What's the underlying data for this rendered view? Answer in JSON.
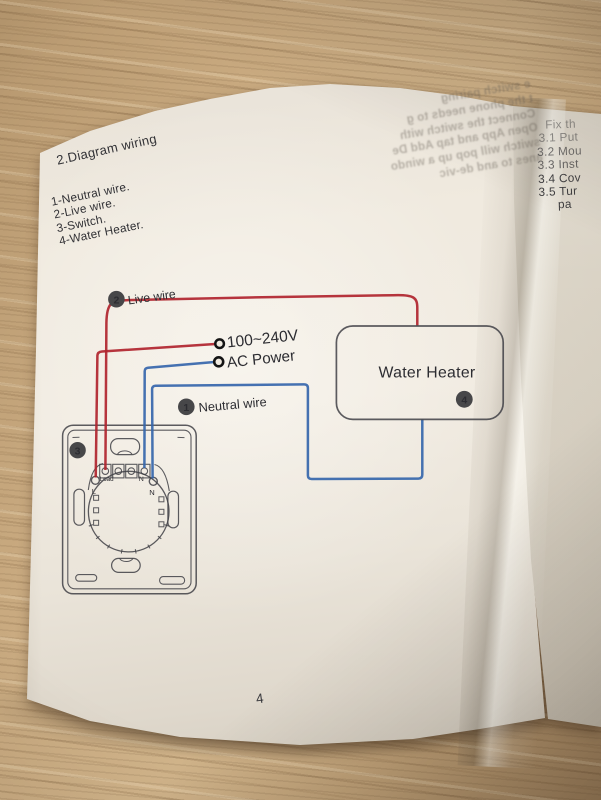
{
  "manual": {
    "section_title": "2.Diagram wiring",
    "legend_items": [
      "1-Neutral wire.",
      "2-Live wire.",
      "3-Switch.",
      "4-Water Heater."
    ],
    "page_number": "4"
  },
  "diagram": {
    "live_wire": {
      "badge": "2",
      "label": "Live wire"
    },
    "neutral_wire": {
      "badge": "1",
      "label": "Neutral wire"
    },
    "power": {
      "line1": "100~240V",
      "line2": "AC Power"
    },
    "water_heater": {
      "label": "Water Heater",
      "badge": "4"
    },
    "switch": {
      "badge": "3",
      "terminal_load": "Load",
      "terminal_n": "N",
      "side_l": "L",
      "side_n": "N"
    },
    "colors": {
      "live": "#b0242e",
      "neutral": "#3566ab",
      "ink": "#3f3f45",
      "badge": "#474749"
    }
  },
  "right_page": {
    "lines": [
      "Fix th",
      "3.1 Put",
      "3.2 Mou",
      "3.3 Inst",
      "3.4 Cov",
      "3.5 Tur",
      "pa"
    ]
  },
  "bleed_through": {
    "lines": [
      "e switch pairing",
      "t the phone needs to g",
      "Connect the switch with",
      "Open App and tap Add De",
      "switch will pop up a windo",
      "anes to and de-vic"
    ]
  }
}
